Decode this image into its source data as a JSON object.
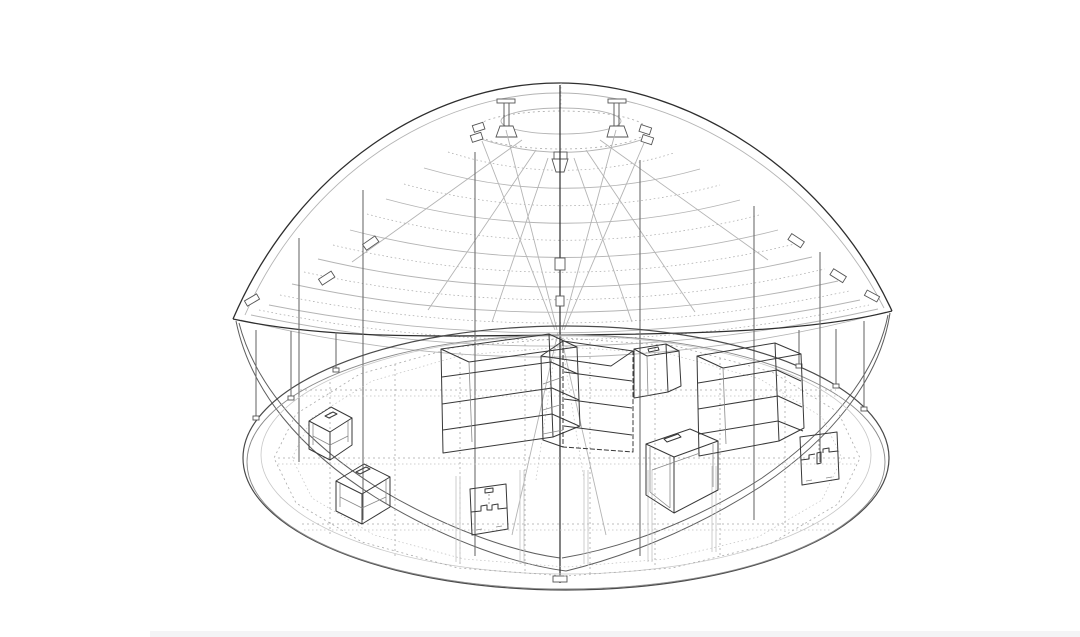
{
  "drawing": {
    "kind": "isometric wireframe CAD line drawing",
    "subject": "Leaf-shaped lattice canopy pavilion over an oval floor deck with flat-pack shelving racks and crate stools",
    "palette": {
      "background": "#ffffff",
      "line_dark": "#2e2e2e",
      "line_medium": "#5f5f5f",
      "line_light": "#b4b4b4",
      "line_dotted": "#a9a9a9",
      "bottom_strip": "#f4f4f6"
    },
    "components": {
      "canopy": {
        "label": "leaf-shaped lattice canopy shell",
        "lattice_arcs": 9,
        "fine_arcs": 7,
        "radial_struts": 6,
        "edge_plates": 6
      },
      "apex": {
        "label": "apex compression ring with mast capitals and center mast",
        "capitals": 2,
        "rings": 2
      },
      "masts": {
        "label": "interior masts",
        "count": 7
      },
      "floor": {
        "label": "oval floor deck with dotted joist grid",
        "rim_rings": 3,
        "perimeter_posts": 6,
        "grid_lines_vertical": 8,
        "grid_lines_horizontal": 3
      },
      "furniture": [
        {
          "label": "shelf rack left",
          "shelves": 3
        },
        {
          "label": "shelf rack center",
          "shelves": 3
        },
        {
          "label": "shelf rack right",
          "shelves": 3
        },
        {
          "label": "small open crate"
        },
        {
          "label": "crate stool upper left"
        },
        {
          "label": "crate stool lower left"
        },
        {
          "label": "flat-pack panel front"
        },
        {
          "label": "large open crate"
        },
        {
          "label": "flat-pack panel right"
        }
      ]
    }
  }
}
